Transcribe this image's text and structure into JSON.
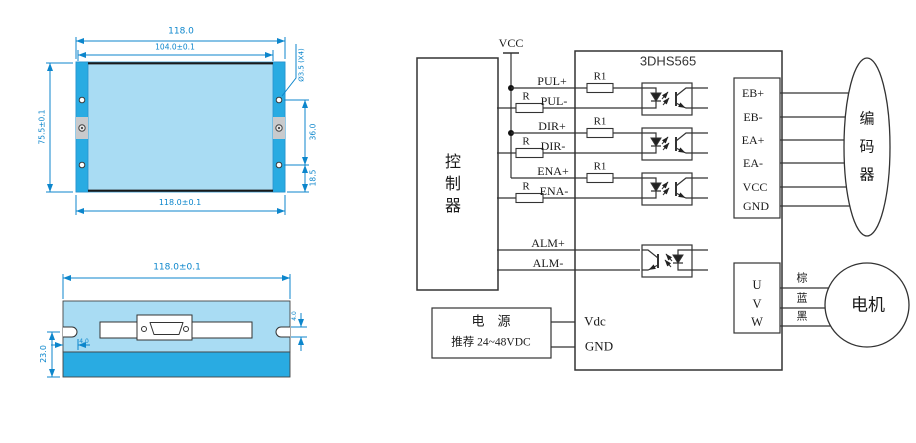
{
  "palette": {
    "body_light": "#A9DCF3",
    "body_dark": "#29ABE2",
    "dimension_blue": "#0C86CC",
    "screw_gray": "#C9CACC",
    "line_dark": "#333333",
    "background": "#FFFFFF"
  },
  "mech": {
    "top_view": {
      "outer_width": "118.0",
      "inner_width": "104.0±0.1",
      "height_left": "75.5±0.1",
      "hole_note": "Ø3.5 (X4)",
      "right_upper": "36.0",
      "right_lower": "18.5",
      "bottom_width": "118.0±0.1"
    },
    "side_view": {
      "top_width": "118.0±0.1",
      "height_left": "23.0",
      "notch_depth": "4.0",
      "notch_height": "4.0"
    }
  },
  "wiring": {
    "title": "3DHS565",
    "vcc_rail": "VCC",
    "controller_chars": [
      "控",
      "制",
      "器"
    ],
    "signals": {
      "pul_plus": "PUL+",
      "pul_minus": "PUL-",
      "dir_plus": "DIR+",
      "dir_minus": "DIR-",
      "ena_plus": "ENA+",
      "ena_minus": "ENA-",
      "alm_plus": "ALM+",
      "alm_minus": "ALM-"
    },
    "resistor_external": "R",
    "resistor_internal": "R1",
    "encoder_terminals": [
      "EB+",
      "EB-",
      "EA+",
      "EA-",
      "VCC",
      "GND"
    ],
    "encoder_chars": [
      "编",
      "码",
      "器"
    ],
    "motor_terminals": [
      "U",
      "V",
      "W"
    ],
    "motor_wire_colors": [
      "棕",
      "蓝",
      "黑"
    ],
    "motor_label": "电机",
    "power": {
      "name": "电　源",
      "spec": "推荐 24~48VDC"
    },
    "vdc_label": "Vdc",
    "gnd_label": "GND"
  }
}
